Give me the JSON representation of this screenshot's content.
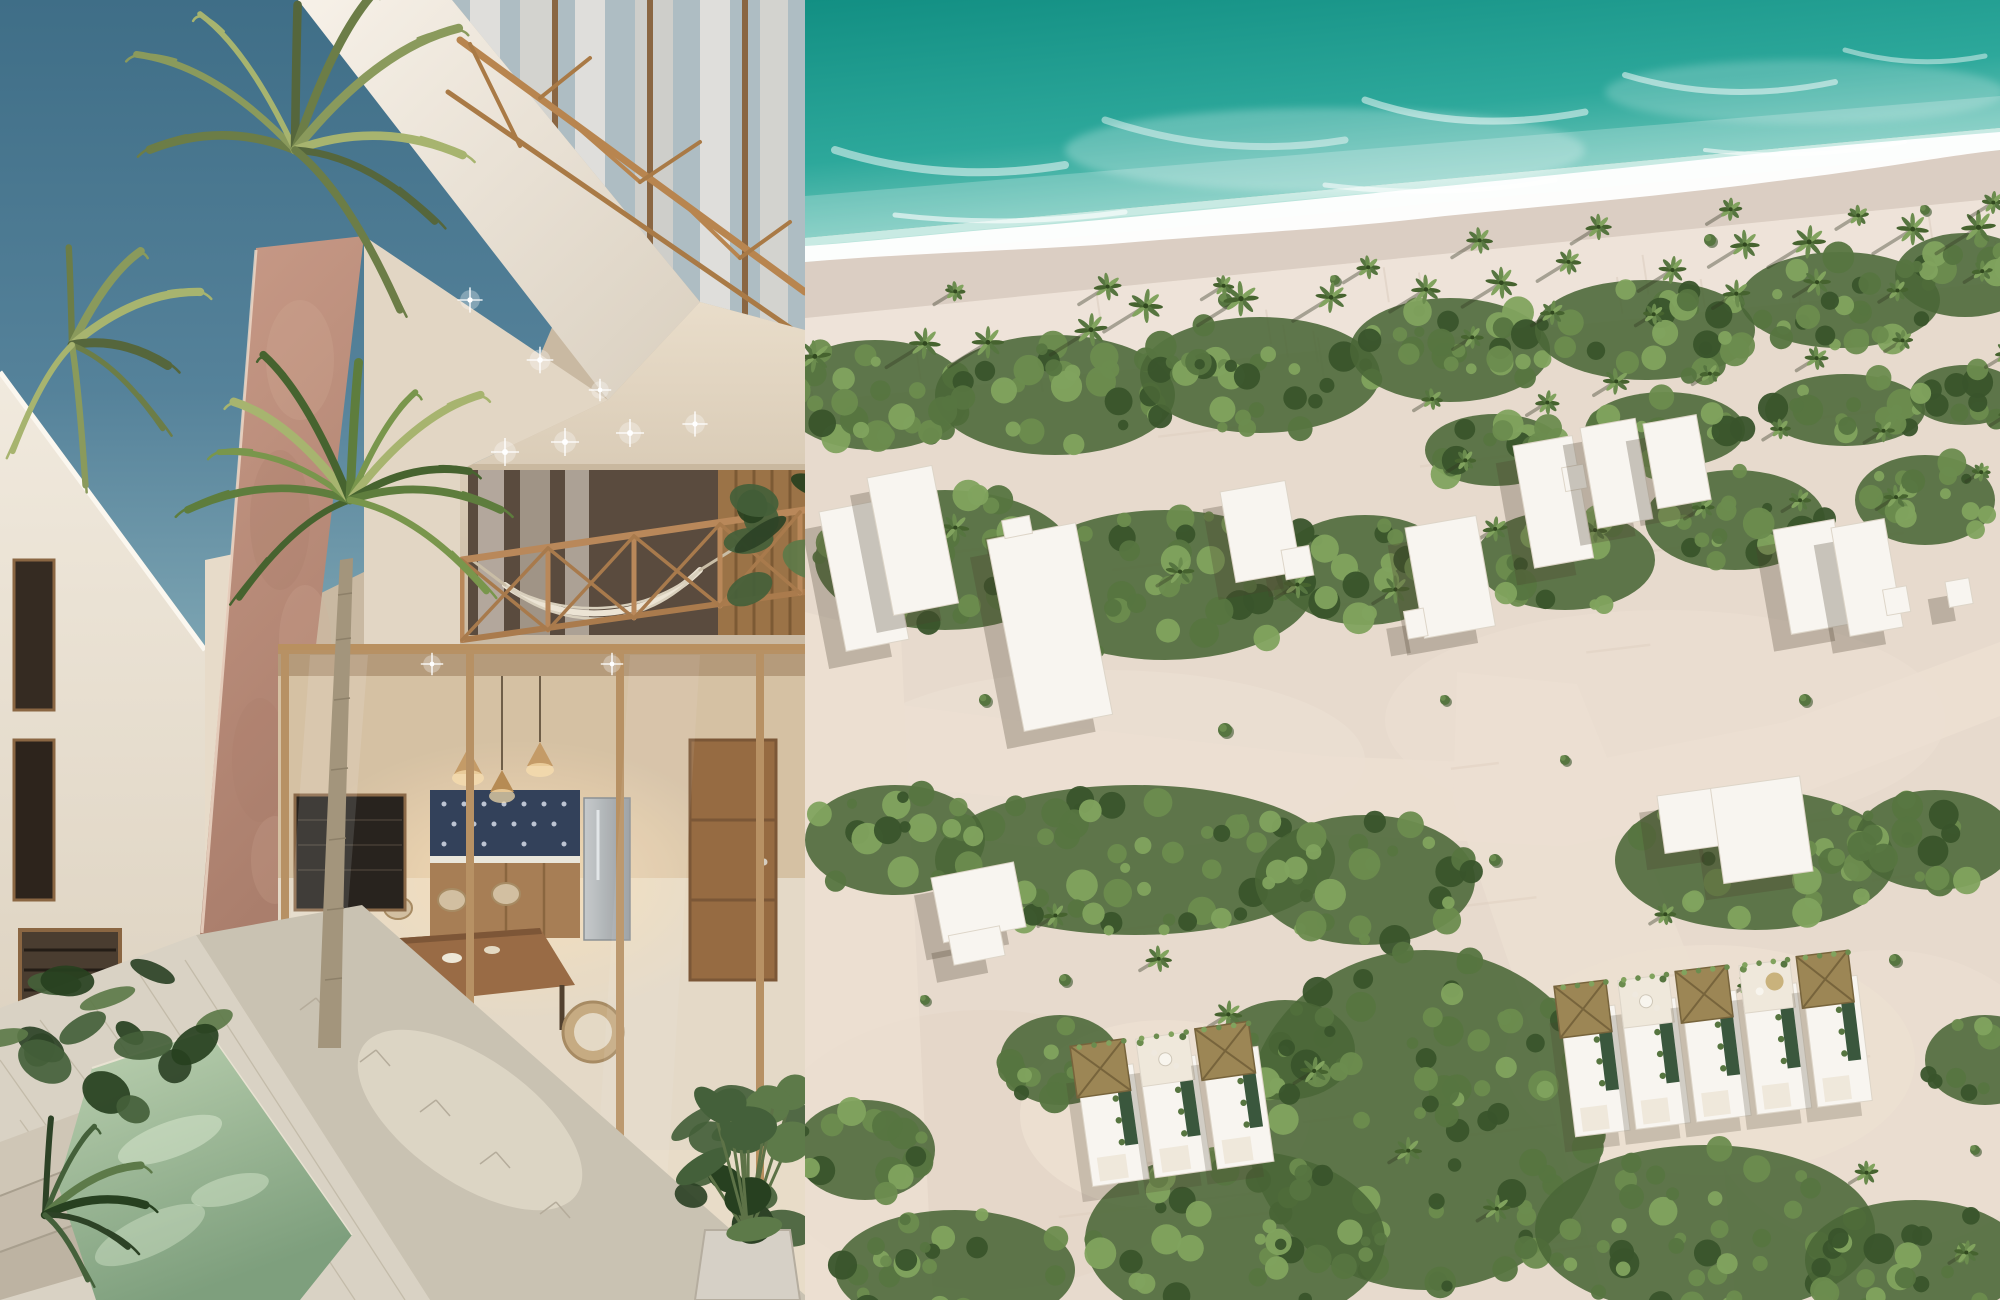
{
  "scene": {
    "left_panel": "courtyard render of boutique villa with palm and plunge pool",
    "right_panel": "aerial render of beachfront development with ocean, sand roads and villas"
  },
  "palette": {
    "sky_top": "#3f6e87",
    "sky_mid": "#55829a",
    "sky_low": "#7ca4b2",
    "fascia_light": "#f7f1e8",
    "fascia_dark": "#d9cfbf",
    "wall_light": "#f1eade",
    "wall_shade": "#d6cab6",
    "cream_light": "#e9ddca",
    "cream_shade": "#c9b9a2",
    "rose_light": "#c89a87",
    "rose_dark": "#aa7e6c",
    "wood": "#b8864f",
    "wood_dark": "#8a6238",
    "glass": "#aebdc3",
    "curtain": "#e8e4df",
    "interior_wall": "#d9c2a2",
    "cabinet": "#a87c50",
    "steel": "#b9bdbe",
    "table_wood": "#99683f",
    "floor": "#e8dcc8",
    "glow": "#ffdfae",
    "pool_light": "#bdd2b2",
    "pool_deep": "#7e9f7d",
    "pool_wall": "#d9cfba",
    "deck": "#d9d2c4",
    "walkway": "#c9c2b2",
    "plant_dark": "#2d4226",
    "plant_mid": "#44603a",
    "plant_light": "#5d7a49",
    "palm_deep": "#46632f",
    "palm_mid": "#5e7d3d",
    "palm_light": "#79964c",
    "palm_sun": "#a7b46f",
    "palm_olive1": "#6c7d47",
    "palm_olive2": "#8a9a5c",
    "trunk": "#a3957c",
    "ocean_deep": "#0f8c80",
    "ocean_mid": "#2da89b",
    "ocean_shallow": "#7fcdc1",
    "ocean_pale": "#b9e4db",
    "foam": "#ffffff",
    "wet_sand": "#dbcec3",
    "beach": "#eee3d9",
    "sand": "#e7dacd",
    "road": "#ecdfd1",
    "veg_base": "#4a6637",
    "veg_dark": "#39542b",
    "veg_mid": "#567540",
    "veg_light": "#6b8c4e",
    "veg_bright": "#81a35e",
    "building_white": "#f8f5f0",
    "building_edge": "#ddd5c8",
    "shadow": "#4a3f2f",
    "thatch": "#9c8655",
    "thatch_dark": "#77643c",
    "thatch_light": "#c9b27c",
    "villa_pool": "#3a573d",
    "villa_deck": "#efe8db"
  },
  "right_aerial": {
    "veg_patches": [
      {
        "cx": 70,
        "cy": 395,
        "rx": 95,
        "ry": 55,
        "n": 26
      },
      {
        "cx": 250,
        "cy": 395,
        "rx": 120,
        "ry": 60,
        "n": 30
      },
      {
        "cx": 455,
        "cy": 375,
        "rx": 120,
        "ry": 58,
        "n": 30
      },
      {
        "cx": 645,
        "cy": 350,
        "rx": 100,
        "ry": 52,
        "n": 26
      },
      {
        "cx": 840,
        "cy": 330,
        "rx": 110,
        "ry": 50,
        "n": 26
      },
      {
        "cx": 1035,
        "cy": 300,
        "rx": 100,
        "ry": 48,
        "n": 24
      },
      {
        "cx": 1160,
        "cy": 275,
        "rx": 70,
        "ry": 42,
        "n": 16
      },
      {
        "cx": 690,
        "cy": 450,
        "rx": 70,
        "ry": 36,
        "n": 16
      },
      {
        "cx": 860,
        "cy": 430,
        "rx": 80,
        "ry": 38,
        "n": 18
      },
      {
        "cx": 1040,
        "cy": 410,
        "rx": 80,
        "ry": 36,
        "n": 16
      },
      {
        "cx": 1160,
        "cy": 395,
        "rx": 55,
        "ry": 30,
        "n": 12
      },
      {
        "cx": 140,
        "cy": 560,
        "rx": 130,
        "ry": 70,
        "n": 34
      },
      {
        "cx": 360,
        "cy": 585,
        "rx": 150,
        "ry": 75,
        "n": 38
      },
      {
        "cx": 560,
        "cy": 570,
        "rx": 90,
        "ry": 55,
        "n": 22
      },
      {
        "cx": 760,
        "cy": 560,
        "rx": 90,
        "ry": 50,
        "n": 20
      },
      {
        "cx": 930,
        "cy": 520,
        "rx": 90,
        "ry": 50,
        "n": 20
      },
      {
        "cx": 1120,
        "cy": 500,
        "rx": 70,
        "ry": 45,
        "n": 16
      },
      {
        "cx": 330,
        "cy": 860,
        "rx": 200,
        "ry": 75,
        "n": 46
      },
      {
        "cx": 90,
        "cy": 840,
        "rx": 90,
        "ry": 55,
        "n": 20
      },
      {
        "cx": 560,
        "cy": 880,
        "rx": 110,
        "ry": 65,
        "n": 26
      },
      {
        "cx": 620,
        "cy": 1120,
        "rx": 180,
        "ry": 170,
        "n": 70
      },
      {
        "cx": 430,
        "cy": 1240,
        "rx": 150,
        "ry": 90,
        "n": 40
      },
      {
        "cx": 150,
        "cy": 1270,
        "rx": 120,
        "ry": 60,
        "n": 26
      },
      {
        "cx": 60,
        "cy": 1150,
        "rx": 70,
        "ry": 50,
        "n": 14
      },
      {
        "cx": 950,
        "cy": 860,
        "rx": 140,
        "ry": 70,
        "n": 32
      },
      {
        "cx": 1130,
        "cy": 840,
        "rx": 80,
        "ry": 50,
        "n": 18
      },
      {
        "cx": 900,
        "cy": 1230,
        "rx": 170,
        "ry": 85,
        "n": 40
      },
      {
        "cx": 1110,
        "cy": 1260,
        "rx": 110,
        "ry": 60,
        "n": 24
      },
      {
        "cx": 1180,
        "cy": 1060,
        "rx": 60,
        "ry": 45,
        "n": 12
      },
      {
        "cx": 255,
        "cy": 1060,
        "rx": 60,
        "ry": 45,
        "n": 14
      },
      {
        "cx": 480,
        "cy": 1050,
        "rx": 70,
        "ry": 50,
        "n": 16
      }
    ],
    "palm_rows": [
      {
        "x0": 25,
        "y0": 348,
        "x1": 1185,
        "y1": 228,
        "n": 15,
        "r": 14,
        "sh": 2.6
      },
      {
        "x0": 160,
        "y0": 302,
        "x1": 1188,
        "y1": 192,
        "n": 9,
        "r": 11,
        "sh": 2.2
      },
      {
        "x0": 655,
        "y0": 332,
        "x1": 1190,
        "y1": 272,
        "n": 7,
        "r": 11,
        "sh": 1.8
      },
      {
        "x0": 645,
        "y0": 402,
        "x1": 1190,
        "y1": 342,
        "n": 7,
        "r": 11,
        "sh": 1.8
      },
      {
        "x0": 660,
        "y0": 472,
        "x1": 1190,
        "y1": 416,
        "n": 6,
        "r": 11,
        "sh": 1.8
      },
      {
        "x0": 700,
        "y0": 540,
        "x1": 1190,
        "y1": 482,
        "n": 6,
        "r": 10,
        "sh": 1.7
      },
      {
        "x0": 60,
        "y0": 520,
        "x1": 600,
        "y1": 600,
        "n": 6,
        "r": 12,
        "sh": 1.7
      },
      {
        "x0": 250,
        "y0": 905,
        "x1": 700,
        "y1": 1200,
        "n": 6,
        "r": 12,
        "sh": 1.5
      },
      {
        "x0": 850,
        "y0": 905,
        "x1": 1150,
        "y1": 1250,
        "n": 5,
        "r": 12,
        "sh": 1.5
      }
    ],
    "bushes": [
      {
        "x": 420,
        "y": 300,
        "r": 7
      },
      {
        "x": 530,
        "y": 280,
        "r": 5
      },
      {
        "x": 905,
        "y": 240,
        "r": 6
      },
      {
        "x": 1120,
        "y": 210,
        "r": 5
      },
      {
        "x": 180,
        "y": 700,
        "r": 6
      },
      {
        "x": 420,
        "y": 730,
        "r": 7
      },
      {
        "x": 640,
        "y": 700,
        "r": 5
      },
      {
        "x": 260,
        "y": 980,
        "r": 6
      },
      {
        "x": 120,
        "y": 1000,
        "r": 5
      },
      {
        "x": 760,
        "y": 760,
        "r": 5
      },
      {
        "x": 1000,
        "y": 700,
        "r": 6
      },
      {
        "x": 1090,
        "y": 960,
        "r": 6
      },
      {
        "x": 870,
        "y": 1090,
        "r": 5
      },
      {
        "x": 1170,
        "y": 1150,
        "r": 5
      },
      {
        "x": 690,
        "y": 860,
        "r": 6
      }
    ],
    "buildings": [
      {
        "x": 14,
        "y": 512,
        "rot": -11,
        "rects": [
          [
            0,
            0,
            64,
            142
          ]
        ]
      },
      {
        "x": 62,
        "y": 478,
        "rot": -11,
        "rects": [
          [
            0,
            0,
            66,
            140
          ]
        ]
      },
      {
        "x": 182,
        "y": 540,
        "rot": -11,
        "rects": [
          [
            0,
            0,
            90,
            195
          ],
          [
            18,
            -16,
            28,
            18
          ]
        ]
      },
      {
        "x": 415,
        "y": 492,
        "rot": -10,
        "rects": [
          [
            0,
            0,
            66,
            92
          ],
          [
            50,
            68,
            28,
            30
          ]
        ]
      },
      {
        "x": 600,
        "y": 528,
        "rot": -10,
        "rects": [
          [
            0,
            0,
            72,
            112
          ],
          [
            -16,
            82,
            20,
            28
          ]
        ]
      },
      {
        "x": 708,
        "y": 446,
        "rot": -10,
        "rects": [
          [
            0,
            0,
            60,
            124
          ],
          [
            44,
            30,
            22,
            24
          ]
        ]
      },
      {
        "x": 775,
        "y": 428,
        "rot": -10,
        "rects": [
          [
            0,
            0,
            56,
            102
          ]
        ]
      },
      {
        "x": 838,
        "y": 424,
        "rot": -10,
        "rects": [
          [
            0,
            0,
            54,
            86
          ]
        ]
      },
      {
        "x": 968,
        "y": 530,
        "rot": -10,
        "rects": [
          [
            0,
            0,
            62,
            106
          ]
        ]
      },
      {
        "x": 1026,
        "y": 528,
        "rot": -10,
        "rects": [
          [
            0,
            0,
            54,
            110
          ],
          [
            40,
            70,
            24,
            26
          ]
        ]
      },
      {
        "x": 1140,
        "y": 582,
        "rot": -10,
        "rects": [
          [
            0,
            0,
            24,
            26
          ]
        ]
      },
      {
        "x": 852,
        "y": 796,
        "rot": -8,
        "rects": [
          [
            0,
            0,
            58,
            58
          ],
          [
            54,
            0,
            90,
            96
          ]
        ]
      },
      {
        "x": 126,
        "y": 878,
        "rot": -11,
        "rects": [
          [
            0,
            0,
            84,
            66
          ],
          [
            6,
            60,
            52,
            30
          ]
        ]
      }
    ],
    "clearings": [
      {
        "cx": 360,
        "cy": 1115,
        "rx": 145,
        "ry": 95
      },
      {
        "cx": 905,
        "cy": 1060,
        "rx": 205,
        "ry": 115
      }
    ],
    "villa_clusters": [
      {
        "x": 268,
        "y": 1046,
        "rot": -8,
        "uw": 63,
        "uh": 142,
        "units": [
          "thatch",
          "deck_table",
          "thatch"
        ]
      },
      {
        "x": 752,
        "y": 986,
        "rot": -7,
        "uw": 61,
        "uh": 152,
        "units": [
          "thatch",
          "deck_table",
          "thatch",
          "deck_parasol",
          "thatch"
        ]
      }
    ],
    "streaks": {
      "sand_n": 26,
      "beach_n": 18
    }
  },
  "left_scene": {
    "palm_crowns": [
      {
        "cx": 350,
        "cy": 500,
        "r": 165,
        "a0": -215,
        "a1": 35,
        "n": 11,
        "tone": "fresh"
      },
      {
        "cx": 295,
        "cy": 150,
        "r": 195,
        "a0": -185,
        "a1": 60,
        "n": 9,
        "tone": "olive"
      },
      {
        "cx": 72,
        "cy": 345,
        "r": 135,
        "a0": -95,
        "a1": 115,
        "n": 7,
        "tone": "olive"
      },
      {
        "cx": 45,
        "cy": 1215,
        "r": 105,
        "a0": -85,
        "a1": 55,
        "n": 6,
        "tone": "dark"
      }
    ],
    "plant_clusters": [
      {
        "cx": 112,
        "cy": 1030,
        "rx": 115,
        "ry": 80,
        "n": 16,
        "tone": "dark"
      },
      {
        "cx": 752,
        "cy": 1160,
        "rx": 62,
        "ry": 92,
        "n": 12,
        "tone": "dark"
      },
      {
        "cx": 778,
        "cy": 548,
        "rx": 52,
        "ry": 85,
        "n": 10,
        "tone": "dark"
      }
    ],
    "lights": [
      {
        "x": 505,
        "y": 452,
        "s": 1
      },
      {
        "x": 565,
        "y": 442,
        "s": 1
      },
      {
        "x": 630,
        "y": 433,
        "s": 1
      },
      {
        "x": 695,
        "y": 424,
        "s": 0.9
      },
      {
        "x": 470,
        "y": 300,
        "s": 0.9
      },
      {
        "x": 540,
        "y": 360,
        "s": 0.95
      },
      {
        "x": 600,
        "y": 390,
        "s": 0.8
      },
      {
        "x": 432,
        "y": 664,
        "s": 0.8
      },
      {
        "x": 612,
        "y": 664,
        "s": 0.8
      }
    ]
  }
}
